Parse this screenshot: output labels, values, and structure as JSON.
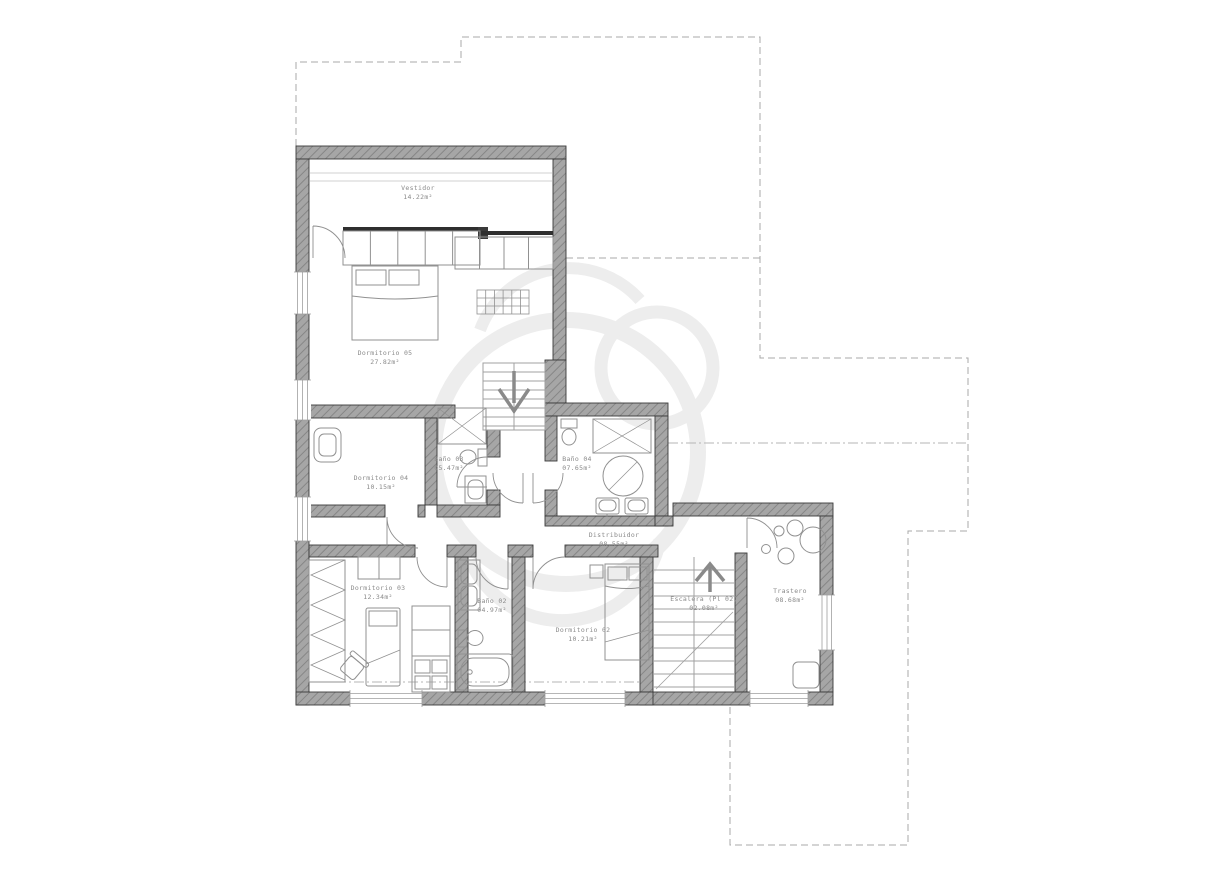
{
  "drawing": {
    "type": "floor-plan",
    "language": "es",
    "floor": "upper"
  },
  "rooms": [
    {
      "id": "vestidor",
      "name": "Vestidor",
      "area": "14.22m²"
    },
    {
      "id": "dormitorio-05",
      "name": "Dormitorio 05",
      "area": "27.82m²"
    },
    {
      "id": "dormitorio-04",
      "name": "Dormitorio 04",
      "area": "10.15m²"
    },
    {
      "id": "bano-03",
      "name": "Baño 03",
      "area": "05.47m²"
    },
    {
      "id": "bano-04",
      "name": "Baño 04",
      "area": "07.65m²"
    },
    {
      "id": "distribuidor",
      "name": "Distribuidor",
      "area": "08.55m²"
    },
    {
      "id": "dormitorio-03",
      "name": "Dormitorio 03",
      "area": "12.34m²"
    },
    {
      "id": "bano-02",
      "name": "Baño 02",
      "area": "04.97m²"
    },
    {
      "id": "dormitorio-02",
      "name": "Dormitorio 02",
      "area": "10.21m²"
    },
    {
      "id": "escalera",
      "name": "Escalera (Pl 02)",
      "area": "02.08m²"
    },
    {
      "id": "trastero",
      "name": "Trastero",
      "area": "08.68m²"
    }
  ],
  "icons": {
    "stair_down_arrow": "stair direction down",
    "stair_up_arrow": "stair direction up"
  },
  "colors": {
    "background": "#ffffff",
    "wall_fill": "#a6a6a6",
    "wall_hatch": "#868686",
    "wall_outline": "#3a3a3a",
    "furniture_line": "#919191",
    "label_text": "#8a8a8a",
    "dashed_outline": "#a8a8a8",
    "watermark": "#ededed"
  }
}
